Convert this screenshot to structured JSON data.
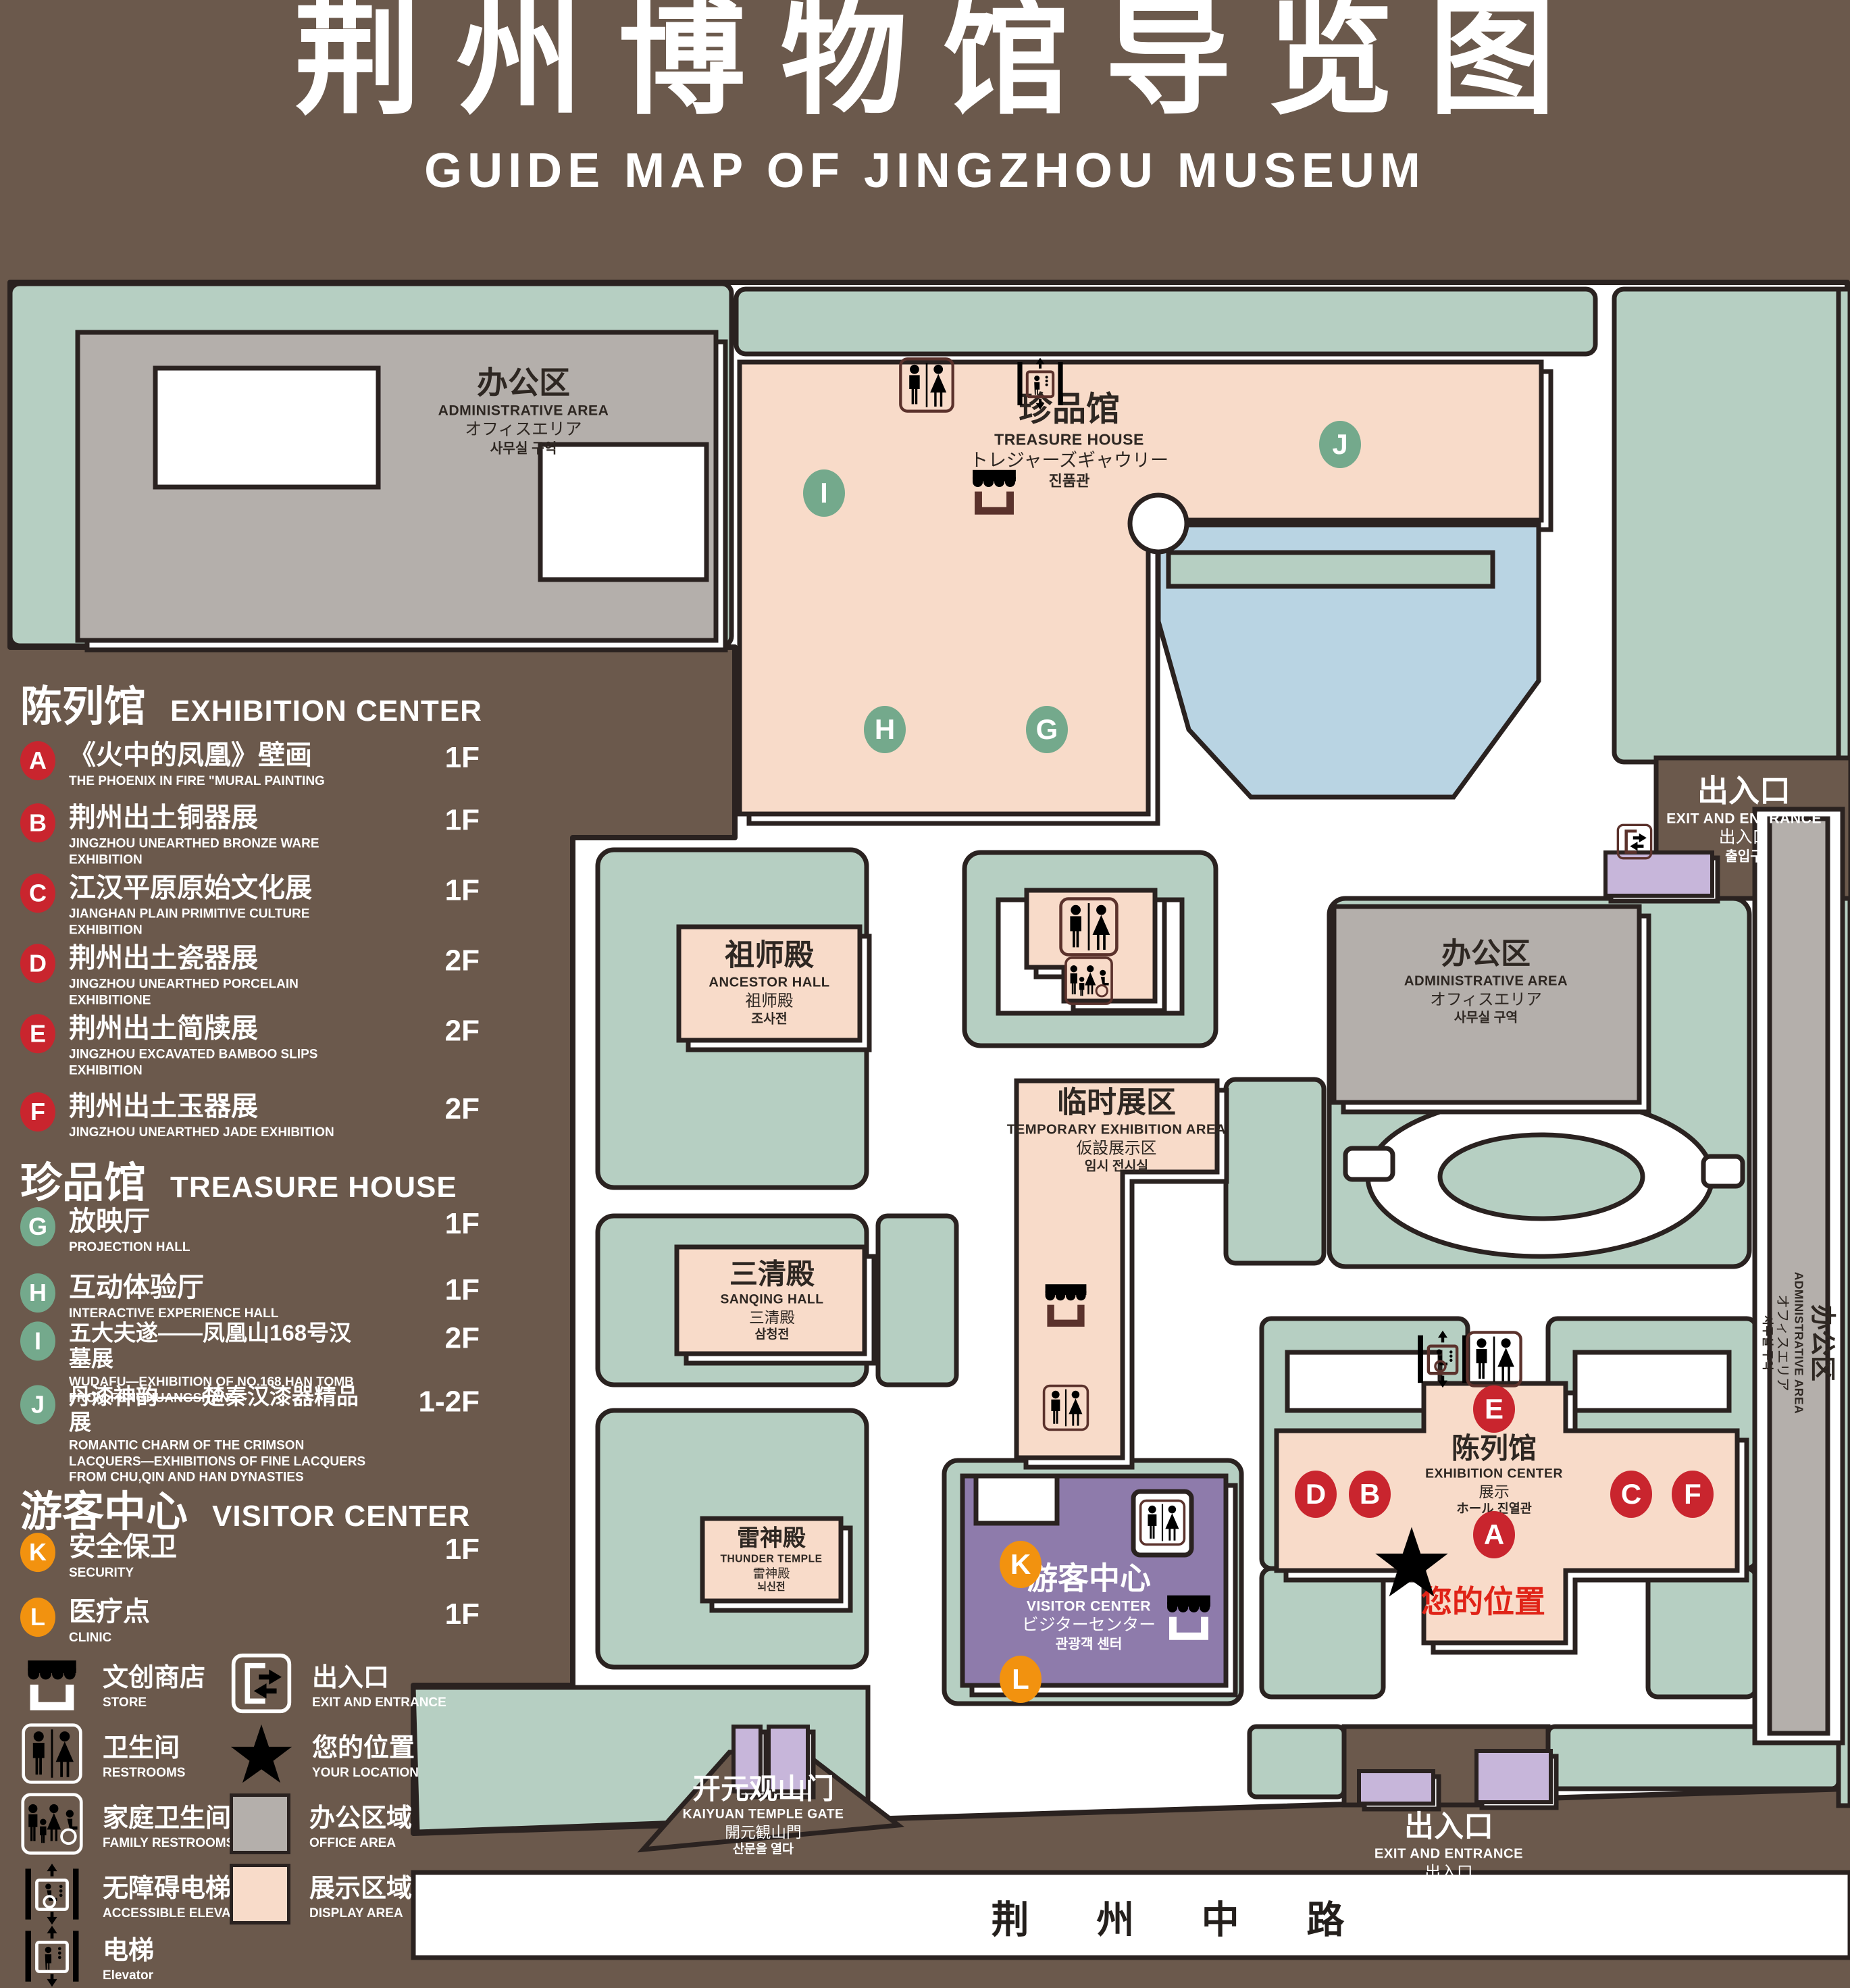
{
  "title": {
    "zh": "荆州博物馆导览图",
    "en": "GUIDE MAP OF JINGZHOU MUSEUM"
  },
  "colors": {
    "background": "#6b594c",
    "courtyard_green": "#b6cfc2",
    "display_pink": "#f8dbc9",
    "office_gray": "#b4afab",
    "lake_blue": "#b9d4e3",
    "visitor_purple": "#8e7bab",
    "gate_purple": "#c7b6da",
    "marker_red": "#c9252e",
    "marker_green": "#74a98c",
    "marker_orange": "#f2920f",
    "icon_brown": "#5b322c",
    "location_red": "#e02317"
  },
  "legend": {
    "sections": [
      {
        "zh": "陈列馆",
        "en": "EXHIBITION CENTER",
        "items": [
          {
            "id": "A",
            "zh": "《火中的凤凰》壁画",
            "en": "THE PHOENIX IN FIRE \"MURAL PAINTING",
            "floor": "1F"
          },
          {
            "id": "B",
            "zh": "荆州出土铜器展",
            "en": "JINGZHOU UNEARTHED BRONZE WARE EXHIBITION",
            "floor": "1F"
          },
          {
            "id": "C",
            "zh": "江汉平原原始文化展",
            "en": "JIANGHAN PLAIN PRIMITIVE CULTURE EXHIBITION",
            "floor": "1F"
          },
          {
            "id": "D",
            "zh": "荆州出土瓷器展",
            "en": "JINGZHOU UNEARTHED PORCELAIN EXHIBITIONE",
            "floor": "2F"
          },
          {
            "id": "E",
            "zh": "荆州出土简牍展",
            "en": "JINGZHOU EXCAVATED BAMBOO SLIPS EXHIBITION",
            "floor": "2F"
          },
          {
            "id": "F",
            "zh": "荆州出土玉器展",
            "en": "JINGZHOU UNEARTHED JADE EXHIBITION",
            "floor": "2F"
          }
        ]
      },
      {
        "zh": "珍品馆",
        "en": "TREASURE HOUSE",
        "items": [
          {
            "id": "G",
            "zh": "放映厅",
            "en": "PROJECTION HALL",
            "floor": "1F"
          },
          {
            "id": "H",
            "zh": "互动体验厅",
            "en": "INTERACTIVE EXPERIENCE HALL",
            "floor": "1F"
          },
          {
            "id": "I",
            "zh": "五大夫遂——凤凰山168号汉墓展",
            "en": "WUDAFU—EXHIBITION OF NO.168 HAN TOMB FROM FENGHUANGSHAN",
            "floor": "2F"
          },
          {
            "id": "J",
            "zh": "丹漆神韵——楚秦汉漆器精品展",
            "en": "ROMANTIC CHARM OF THE CRIMSON LACQUERS—EXHIBITIONS OF FINE LACQUERS FROM CHU,QIN AND HAN DYNASTIES",
            "floor": "1-2F"
          }
        ]
      },
      {
        "zh": "游客中心",
        "en": "VISITOR CENTER",
        "items": [
          {
            "id": "K",
            "zh": "安全保卫",
            "en": "SECURITY",
            "floor": "1F"
          },
          {
            "id": "L",
            "zh": "医疗点",
            "en": "CLINIC",
            "floor": "1F"
          }
        ]
      }
    ],
    "symbols": [
      {
        "icon": "store-icon",
        "zh": "文创商店",
        "en": "STORE"
      },
      {
        "icon": "exit-icon",
        "zh": "出入口",
        "en": "EXIT AND ENTRANCE"
      },
      {
        "icon": "restroom-icon",
        "zh": "卫生间",
        "en": "RESTROOMS"
      },
      {
        "icon": "your-location-icon",
        "zh": "您的位置",
        "en": "YOUR LOCATION"
      },
      {
        "icon": "family-restroom-icon",
        "zh": "家庭卫生间",
        "en": "FAMILY RESTROOMS"
      },
      {
        "icon": "office-area-swatch",
        "zh": "办公区域",
        "en": "OFFICE AREA"
      },
      {
        "icon": "accessible-elevator-icon",
        "zh": "无障碍电梯",
        "en": "ACCESSIBLE ELEVATOR"
      },
      {
        "icon": "display-area-swatch",
        "zh": "展示区域",
        "en": "DISPLAY AREA"
      },
      {
        "icon": "elevator-icon",
        "zh": "电梯",
        "en": "Elevator"
      }
    ]
  },
  "map": {
    "buildings": {
      "admin_nw": {
        "zh": "办公区",
        "en": "ADMINISTRATIVE AREA",
        "ja": "オフィスエリア",
        "ko": "사무실 구역"
      },
      "treasure": {
        "zh": "珍品馆",
        "en": "TREASURE HOUSE",
        "ja": "トレジャーズギャウリー",
        "ko": "진품관"
      },
      "ancestor": {
        "zh": "祖师殿",
        "en": "ANCESTOR HALL",
        "ja": "祖师殿",
        "ko": "조사전"
      },
      "temporary": {
        "zh": "临时展区",
        "en": "TEMPORARY EXHIBITION AREA",
        "ja": "仮設展示区",
        "ko": "임시 전시실"
      },
      "admin_e": {
        "zh": "办公区",
        "en": "ADMINISTRATIVE AREA",
        "ja": "オフィスエリア",
        "ko": "사무실 구역"
      },
      "admin_se": {
        "zh": "办公区",
        "en": "ADMINISTRATIVE AREA",
        "ja": "オフィスエリア",
        "ko": "사무실 구역"
      },
      "sanqing": {
        "zh": "三清殿",
        "en": "SANQING HALL",
        "ja": "三清殿",
        "ko": "삼청전"
      },
      "thunder": {
        "zh": "雷神殿",
        "en": "THUNDER TEMPLE",
        "ja": "雷神殿",
        "ko": "뇌신전"
      },
      "visitor": {
        "zh": "游客中心",
        "en": "VISITOR CENTER",
        "ja": "ビジターセンター",
        "ko": "관광객 센터"
      },
      "exhibition": {
        "zh": "陈列馆",
        "en": "EXHIBITION CENTER",
        "ja": "展示",
        "ko": "ホール 진열관"
      }
    },
    "gates": {
      "exit_east": {
        "zh": "出入口",
        "en": "EXIT AND ENTRANCE",
        "ja": "出入口",
        "ko": "출입구"
      },
      "exit_south": {
        "zh": "出入口",
        "en": "EXIT AND ENTRANCE",
        "ja": "出入口",
        "ko": "출입구"
      },
      "kaiyuan": {
        "zh": "开元观山门",
        "en": "KAIYUAN TEMPLE GATE",
        "ja": "開元観山門",
        "ko": "산문을 열다"
      }
    },
    "road": "荆 州 中 路",
    "your_location": "您的位置",
    "markers": {
      "A": "A",
      "B": "B",
      "C": "C",
      "D": "D",
      "E": "E",
      "F": "F",
      "G": "G",
      "H": "H",
      "I": "I",
      "J": "J",
      "K": "K",
      "L": "L"
    }
  }
}
